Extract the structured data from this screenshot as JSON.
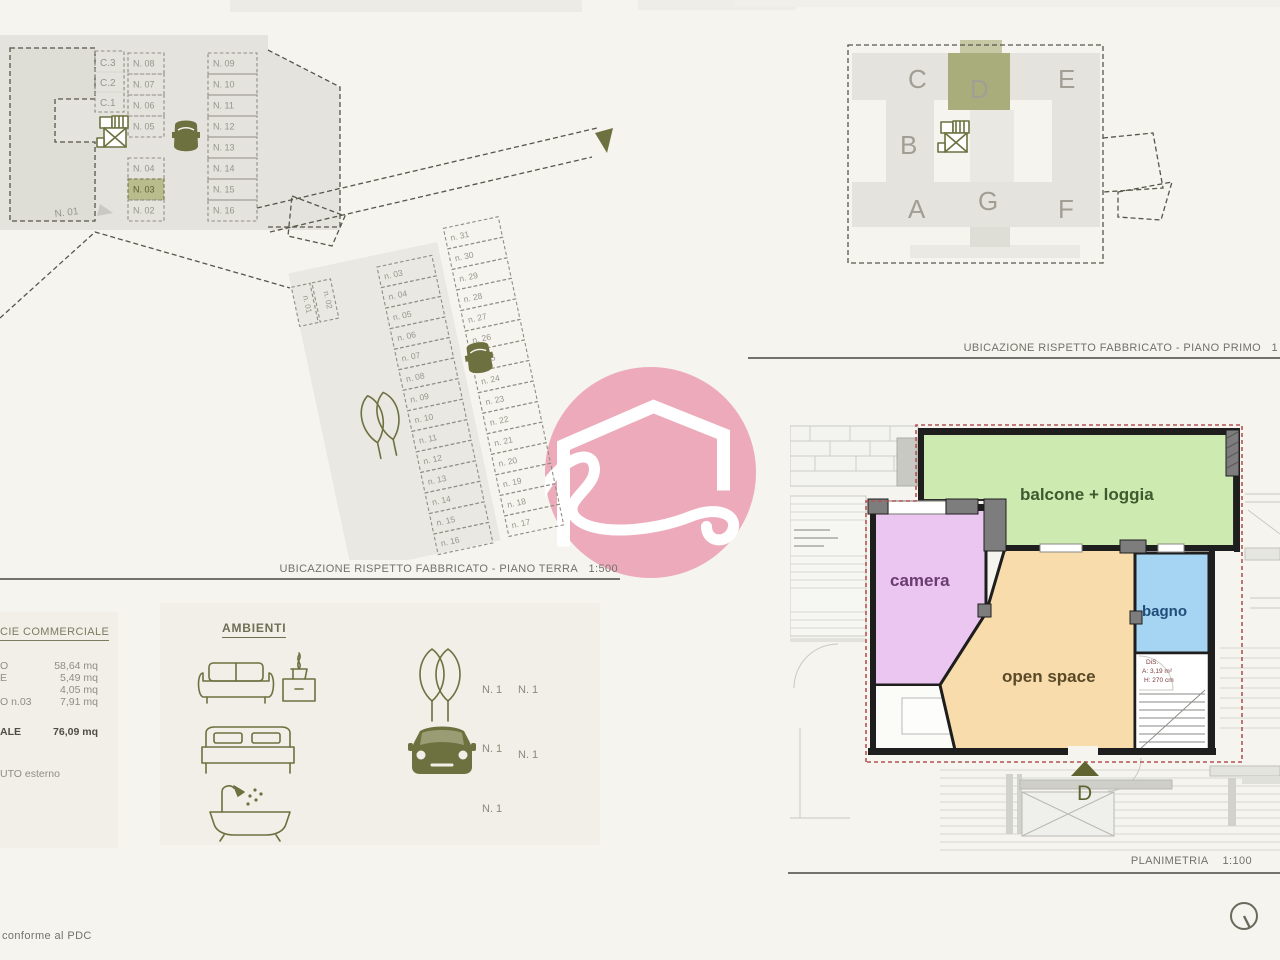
{
  "captions": {
    "terra": "UBICAZIONE RISPETTO FABBRICATO - PIANO TERRA",
    "terra_scale": "1:500",
    "primo": "UBICAZIONE RISPETTO FABBRICATO - PIANO PRIMO",
    "primo_scale": "1",
    "plan": "PLANIMETRIA",
    "plan_scale": "1:100",
    "footer": "conforme al PDC"
  },
  "garage": {
    "c_labels": [
      "C.3",
      "C.2",
      "C.1"
    ],
    "stalls_left": [
      "N. 08",
      "N. 07",
      "N. 06",
      "N. 05",
      "N. 04",
      "N. 03",
      "N. 02"
    ],
    "stalls_right": [
      "N. 09",
      "N. 10",
      "N. 11",
      "N. 12",
      "N. 13",
      "N. 14",
      "N. 15",
      "N. 16"
    ],
    "highlighted_stall": "N. 03",
    "outside_label": "N. 01"
  },
  "lot": {
    "stalls_left": [
      "n. 03",
      "n. 04",
      "n. 05",
      "n. 06",
      "n. 07",
      "n. 08",
      "n. 09",
      "n. 10",
      "n. 11",
      "n. 12",
      "n. 13",
      "n. 14",
      "n. 15",
      "n. 16"
    ],
    "stalls_right": [
      "n. 31",
      "n. 30",
      "n. 29",
      "n. 28",
      "n. 27",
      "n. 26",
      "n. 25",
      "n. 24",
      "n. 23",
      "n. 22",
      "n. 21",
      "n. 20",
      "n. 19",
      "n. 18",
      "n. 17"
    ],
    "stalls_small": [
      "n. 01",
      "n. 02"
    ]
  },
  "building": {
    "units": [
      "C",
      "D",
      "E",
      "B",
      "A",
      "G",
      "F"
    ],
    "highlighted_unit": "D"
  },
  "surfaces": {
    "heading": "CIE COMMERCIALE",
    "rows": [
      {
        "label": "O",
        "value": "58,64 mq"
      },
      {
        "label": "E",
        "value": "5,49 mq"
      },
      {
        "label": "",
        "value": "4,05 mq"
      },
      {
        "label": "O  n.03",
        "value": "7,91 mq"
      }
    ],
    "total_label": "ALE",
    "total_value": "76,09 mq",
    "note": "UTO esterno"
  },
  "ambienti": {
    "heading": "AMBIENTI",
    "counts": {
      "sofa": "N. 1",
      "tree": "N. 1",
      "bed": "N. 1",
      "car": "N. 1",
      "bath": "N. 1"
    }
  },
  "plan": {
    "rooms": [
      {
        "name": "balcone + loggia",
        "color": "#cdeab0",
        "label_color": "#3f5a2e"
      },
      {
        "name": "camera",
        "color": "#eac6f0",
        "label_color": "#6b3c70"
      },
      {
        "name": "open space",
        "color": "#f8dcab",
        "label_color": "#5a4a28"
      },
      {
        "name": "bagno",
        "color": "#a6d4f3",
        "label_color": "#1f4e79"
      }
    ],
    "stair_note": [
      "DiS.",
      "A: 3,19 m²",
      "H: 270 cm"
    ],
    "entrance_label": "D"
  },
  "colors": {
    "accent_olive": "#6d7140",
    "highlight_fill": "#b9bc8c",
    "unit_highlight": "#a9ad7c",
    "watermark_pink": "#edaaba",
    "red_dash": "#b25555"
  }
}
